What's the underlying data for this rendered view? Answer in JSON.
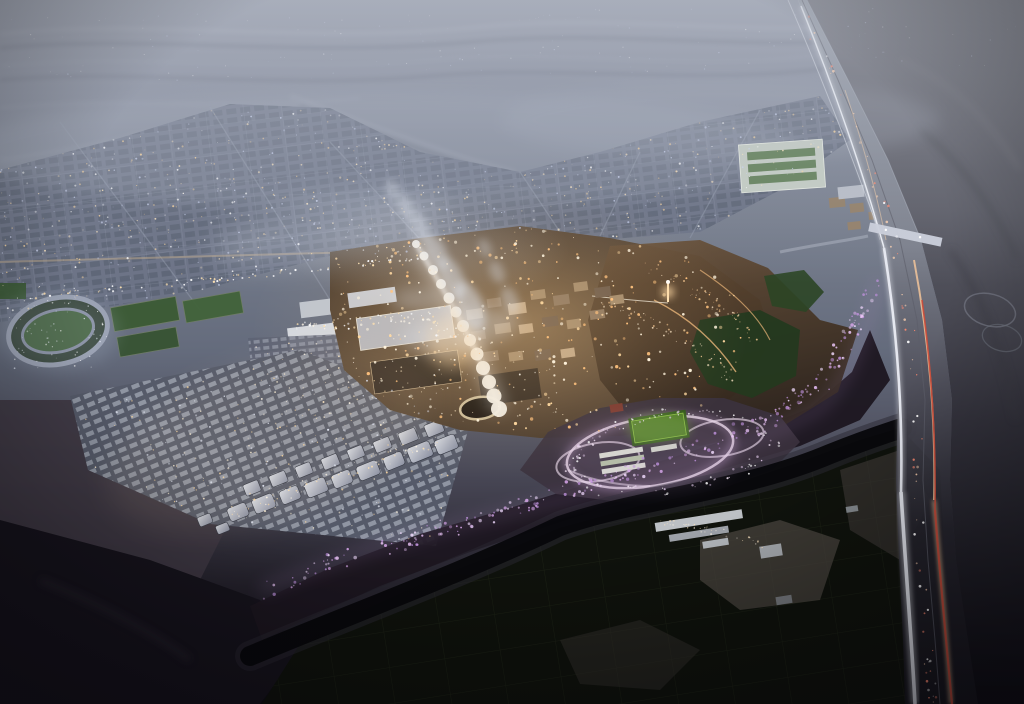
{
  "scene": {
    "type": "aerial-masterplan-render",
    "time_of_day": "dusk",
    "alt_text": "Aerial dusk rendering of a desert city masterplan: a warmly lit historic town core with a white canopy spine, residential districts of white blocks on a dark escarpment, a purple-lit tree promenade, circular park loops with a green pitch, an older blue-grey city grid fading into desert ridges on the horizon, a dark palm-grove wadi with farm plots in the foreground, and a highway with white and red light trails curving along the right edge."
  },
  "palette": {
    "dusk_haze": "#9aa0ac",
    "distant_city": "#6c7386",
    "desert_shadow": "#55565f",
    "warm_light": "#ffd9a0",
    "floodlit_white": "#f2efe8",
    "rock_dark": "#1c1620",
    "wadi_farmland": "#0d100c",
    "park_path_pink": "#e8d8e8",
    "promenade_purple": "#c9a0dd",
    "taillight_red": "#cc4a38",
    "headlight_white": "#eef1f8",
    "pitch_green": "#47761d"
  },
  "light_clusters": [
    {
      "name": "horizon-lights",
      "type": "polygon",
      "seed": 3,
      "count": 150,
      "points": [
        [
          0,
          16
        ],
        [
          1024,
          4
        ],
        [
          1024,
          66
        ],
        [
          0,
          84
        ]
      ],
      "colors": [
        "#ffffff",
        "#cdd6f2"
      ],
      "rmin": 0.3,
      "rmax": 0.7,
      "amin": 0.15,
      "amax": 0.55
    },
    {
      "name": "distant-city-lights",
      "type": "polygon",
      "seed": 7,
      "count": 700,
      "points": [
        [
          0,
          170
        ],
        [
          120,
          138
        ],
        [
          230,
          104
        ],
        [
          330,
          108
        ],
        [
          420,
          152
        ],
        [
          520,
          172
        ],
        [
          600,
          152
        ],
        [
          700,
          122
        ],
        [
          820,
          96
        ],
        [
          850,
          140
        ],
        [
          780,
          190
        ],
        [
          700,
          232
        ],
        [
          600,
          240
        ],
        [
          500,
          232
        ],
        [
          430,
          252
        ],
        [
          330,
          256
        ],
        [
          200,
          290
        ],
        [
          90,
          310
        ],
        [
          0,
          322
        ]
      ],
      "colors": [
        "#ffffff",
        "#ffe8c2",
        "#cdd6f2",
        "#ffd9a0"
      ],
      "rmin": 0.4,
      "rmax": 1.1,
      "amin": 0.25,
      "amax": 0.85
    },
    {
      "name": "dev-warm-lights",
      "type": "polygon",
      "seed": 11,
      "count": 300,
      "points": [
        [
          336,
          252
        ],
        [
          430,
          238
        ],
        [
          540,
          228
        ],
        [
          640,
          242
        ],
        [
          700,
          262
        ],
        [
          750,
          310
        ],
        [
          742,
          360
        ],
        [
          700,
          412
        ],
        [
          620,
          430
        ],
        [
          540,
          434
        ],
        [
          460,
          424
        ],
        [
          386,
          404
        ],
        [
          348,
          362
        ],
        [
          336,
          300
        ]
      ],
      "colors": [
        "#ffd9a0",
        "#ffc27e",
        "#fff3dc"
      ],
      "rmin": 0.5,
      "rmax": 1.7,
      "amin": 0.45,
      "amax": 1.0
    },
    {
      "name": "parking-lights",
      "type": "polygon",
      "seed": 23,
      "count": 150,
      "points": [
        [
          250,
          340
        ],
        [
          545,
          328
        ],
        [
          568,
          416
        ],
        [
          258,
          430
        ]
      ],
      "colors": [
        "#ffe9c4",
        "#fff6e6"
      ],
      "rmin": 0.4,
      "rmax": 1.0,
      "amin": 0.4,
      "amax": 0.9
    },
    {
      "name": "residential-lights",
      "type": "polygon",
      "seed": 31,
      "count": 220,
      "points": [
        [
          76,
          398
        ],
        [
          300,
          352
        ],
        [
          468,
          418
        ],
        [
          434,
          544
        ],
        [
          212,
          522
        ],
        [
          90,
          468
        ]
      ],
      "colors": [
        "#fff1d6",
        "#e8ecf8",
        "#ffd9a0"
      ],
      "rmin": 0.4,
      "rmax": 1.1,
      "amin": 0.35,
      "amax": 0.9
    },
    {
      "name": "purple-promenade-lights",
      "type": "path",
      "seed": 41,
      "count": 260,
      "jitter": 9,
      "points": [
        [
          260,
          592
        ],
        [
          340,
          560
        ],
        [
          430,
          532
        ],
        [
          520,
          506
        ],
        [
          610,
          478
        ],
        [
          690,
          452
        ],
        [
          760,
          422
        ],
        [
          818,
          386
        ],
        [
          856,
          330
        ],
        [
          876,
          278
        ]
      ],
      "colors": [
        "#d9a8ec",
        "#bb8fd8",
        "#f2dcff",
        "#e8c2f4"
      ],
      "rmin": 0.6,
      "rmax": 1.8,
      "amin": 0.4,
      "amax": 0.9
    },
    {
      "name": "park-loop-lights",
      "type": "path",
      "seed": 53,
      "count": 120,
      "jitter": 5,
      "points": [
        [
          566,
          468
        ],
        [
          590,
          440
        ],
        [
          640,
          416
        ],
        [
          700,
          410
        ],
        [
          752,
          422
        ],
        [
          778,
          444
        ],
        [
          742,
          472
        ],
        [
          668,
          490
        ],
        [
          600,
          492
        ],
        [
          566,
          468
        ]
      ],
      "colors": [
        "#f2e4f4",
        "#e0c8e8",
        "#ffffff"
      ],
      "rmin": 0.5,
      "rmax": 1.3,
      "amin": 0.4,
      "amax": 0.9
    },
    {
      "name": "highway-sparks",
      "type": "path",
      "seed": 67,
      "count": 70,
      "jitter": 5,
      "points": [
        [
          804,
          14
        ],
        [
          840,
          88
        ],
        [
          872,
          168
        ],
        [
          896,
          248
        ],
        [
          910,
          330
        ],
        [
          918,
          410
        ],
        [
          916,
          490
        ],
        [
          922,
          570
        ],
        [
          928,
          650
        ],
        [
          932,
          700
        ]
      ],
      "colors": [
        "#ffffff",
        "#ffd2b0",
        "#ff8a70"
      ],
      "rmin": 0.5,
      "rmax": 1.4,
      "amin": 0.4,
      "amax": 0.95
    },
    {
      "name": "city-avenue-lights",
      "type": "path",
      "seed": 71,
      "count": 80,
      "jitter": 3,
      "points": [
        [
          8,
          300
        ],
        [
          120,
          288
        ],
        [
          240,
          277
        ],
        [
          352,
          265
        ],
        [
          420,
          256
        ]
      ],
      "colors": [
        "#ffe2b0",
        "#ffffff"
      ],
      "rmin": 0.5,
      "rmax": 1.2,
      "amin": 0.5,
      "amax": 1.0
    },
    {
      "name": "hill-trail-lights",
      "type": "path",
      "seed": 83,
      "count": 60,
      "jitter": 6,
      "points": [
        [
          596,
          300
        ],
        [
          648,
          318
        ],
        [
          700,
          350
        ],
        [
          736,
          384
        ]
      ],
      "colors": [
        "#ffcf96",
        "#ffe8c8"
      ],
      "rmin": 0.4,
      "rmax": 1.1,
      "amin": 0.4,
      "amax": 0.85
    },
    {
      "name": "hill-trail-lights-upper",
      "type": "path",
      "seed": 89,
      "count": 50,
      "jitter": 6,
      "points": [
        [
          640,
          262
        ],
        [
          686,
          284
        ],
        [
          724,
          310
        ],
        [
          756,
          338
        ]
      ],
      "colors": [
        "#ffcf96",
        "#ffe8c8"
      ],
      "rmin": 0.4,
      "rmax": 1.0,
      "amin": 0.35,
      "amax": 0.8
    },
    {
      "name": "farm-lights",
      "type": "path",
      "seed": 97,
      "count": 36,
      "jitter": 4,
      "points": [
        [
          658,
          520
        ],
        [
          700,
          528
        ],
        [
          740,
          537
        ],
        [
          768,
          550
        ]
      ],
      "colors": [
        "#ffe6c0",
        "#fff6e6"
      ],
      "rmin": 0.4,
      "rmax": 1.0,
      "amin": 0.3,
      "amax": 0.8
    },
    {
      "name": "venue-lights",
      "type": "path",
      "seed": 101,
      "count": 70,
      "jitter": 6,
      "points": [
        [
          292,
          330
        ],
        [
          360,
          322
        ],
        [
          420,
          316
        ],
        [
          456,
          338
        ]
      ],
      "colors": [
        "#ffe2b0",
        "#fff6e6",
        "#ffffff"
      ],
      "rmin": 0.5,
      "rmax": 1.3,
      "amin": 0.5,
      "amax": 1.0
    },
    {
      "name": "stadium-lights",
      "type": "polygon",
      "seed": 103,
      "count": 60,
      "points": [
        [
          8,
          300
        ],
        [
          108,
          292
        ],
        [
          112,
          366
        ],
        [
          12,
          372
        ]
      ],
      "colors": [
        "#e8ecf8",
        "#ffffff"
      ],
      "rmin": 0.4,
      "rmax": 0.9,
      "amin": 0.3,
      "amax": 0.8
    },
    {
      "name": "blocks-edge-lights",
      "type": "path",
      "seed": 107,
      "count": 60,
      "jitter": 6,
      "points": [
        [
          232,
          512
        ],
        [
          300,
          488
        ],
        [
          368,
          464
        ],
        [
          436,
          440
        ]
      ],
      "colors": [
        "#ffe2b0",
        "#fff6e6"
      ],
      "rmin": 0.4,
      "rmax": 1.0,
      "amin": 0.4,
      "amax": 0.9
    }
  ]
}
